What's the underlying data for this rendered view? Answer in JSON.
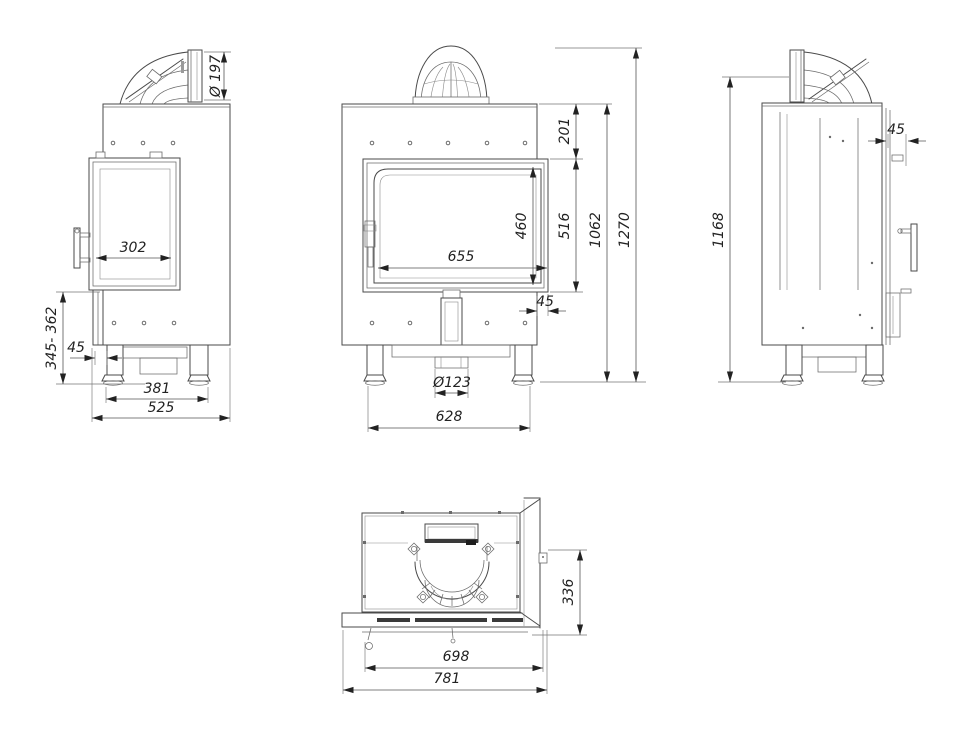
{
  "palette": {
    "ink": "#4a4a4a",
    "background": "#ffffff"
  },
  "dims": {
    "side_left": {
      "flue_diameter": "Ø 197",
      "glass_depth": "302",
      "height_range": "345- 362",
      "front_offset": "45",
      "feet_spacing": "381",
      "total_depth": "525"
    },
    "front": {
      "top_section": "201",
      "glass_height": "460",
      "door_height": "516",
      "glass_width": "655",
      "body_height": "1062",
      "total_height": "1270",
      "door_offset": "45",
      "air_inlet": "Ø123",
      "feet_span": "628"
    },
    "side_right": {
      "flue_axis_height": "1168",
      "flange_depth": "45"
    },
    "top": {
      "plate_depth": "336",
      "inner_width": "698",
      "total_width": "781"
    }
  }
}
